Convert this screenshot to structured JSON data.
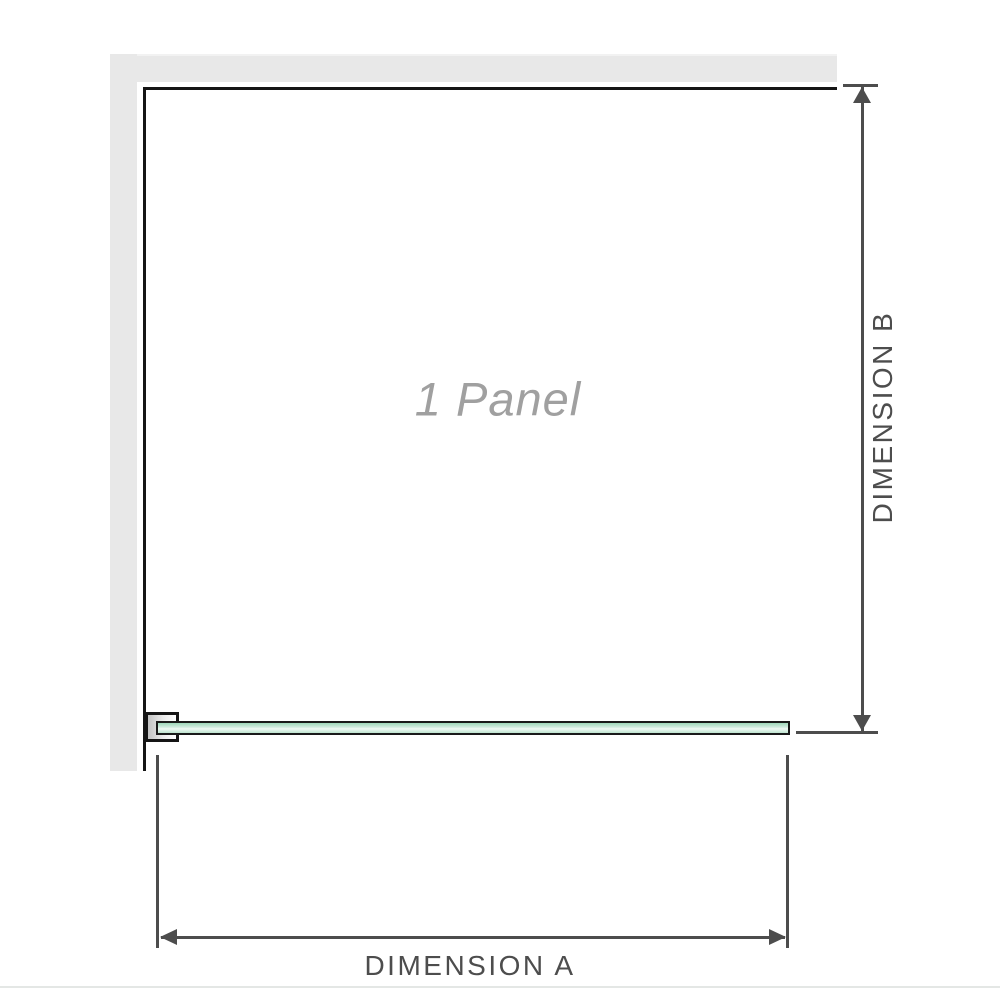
{
  "diagram": {
    "panel_label": "1 Panel",
    "dimensions": {
      "a_label": "DIMENSION A",
      "b_label": "DIMENSION B"
    }
  },
  "colors": {
    "wall": "#e8e8e8",
    "wall_edge_light": "#f2f2f2",
    "wall_face": "#151515",
    "glass_fill": "#9fd8ba",
    "glass_highlight": "#f1faf5",
    "glass_border": "#1a1a1a",
    "dimension": "#4d4d4d",
    "panel_text": "#a0a0a0",
    "separator": "#e4e7e5"
  }
}
